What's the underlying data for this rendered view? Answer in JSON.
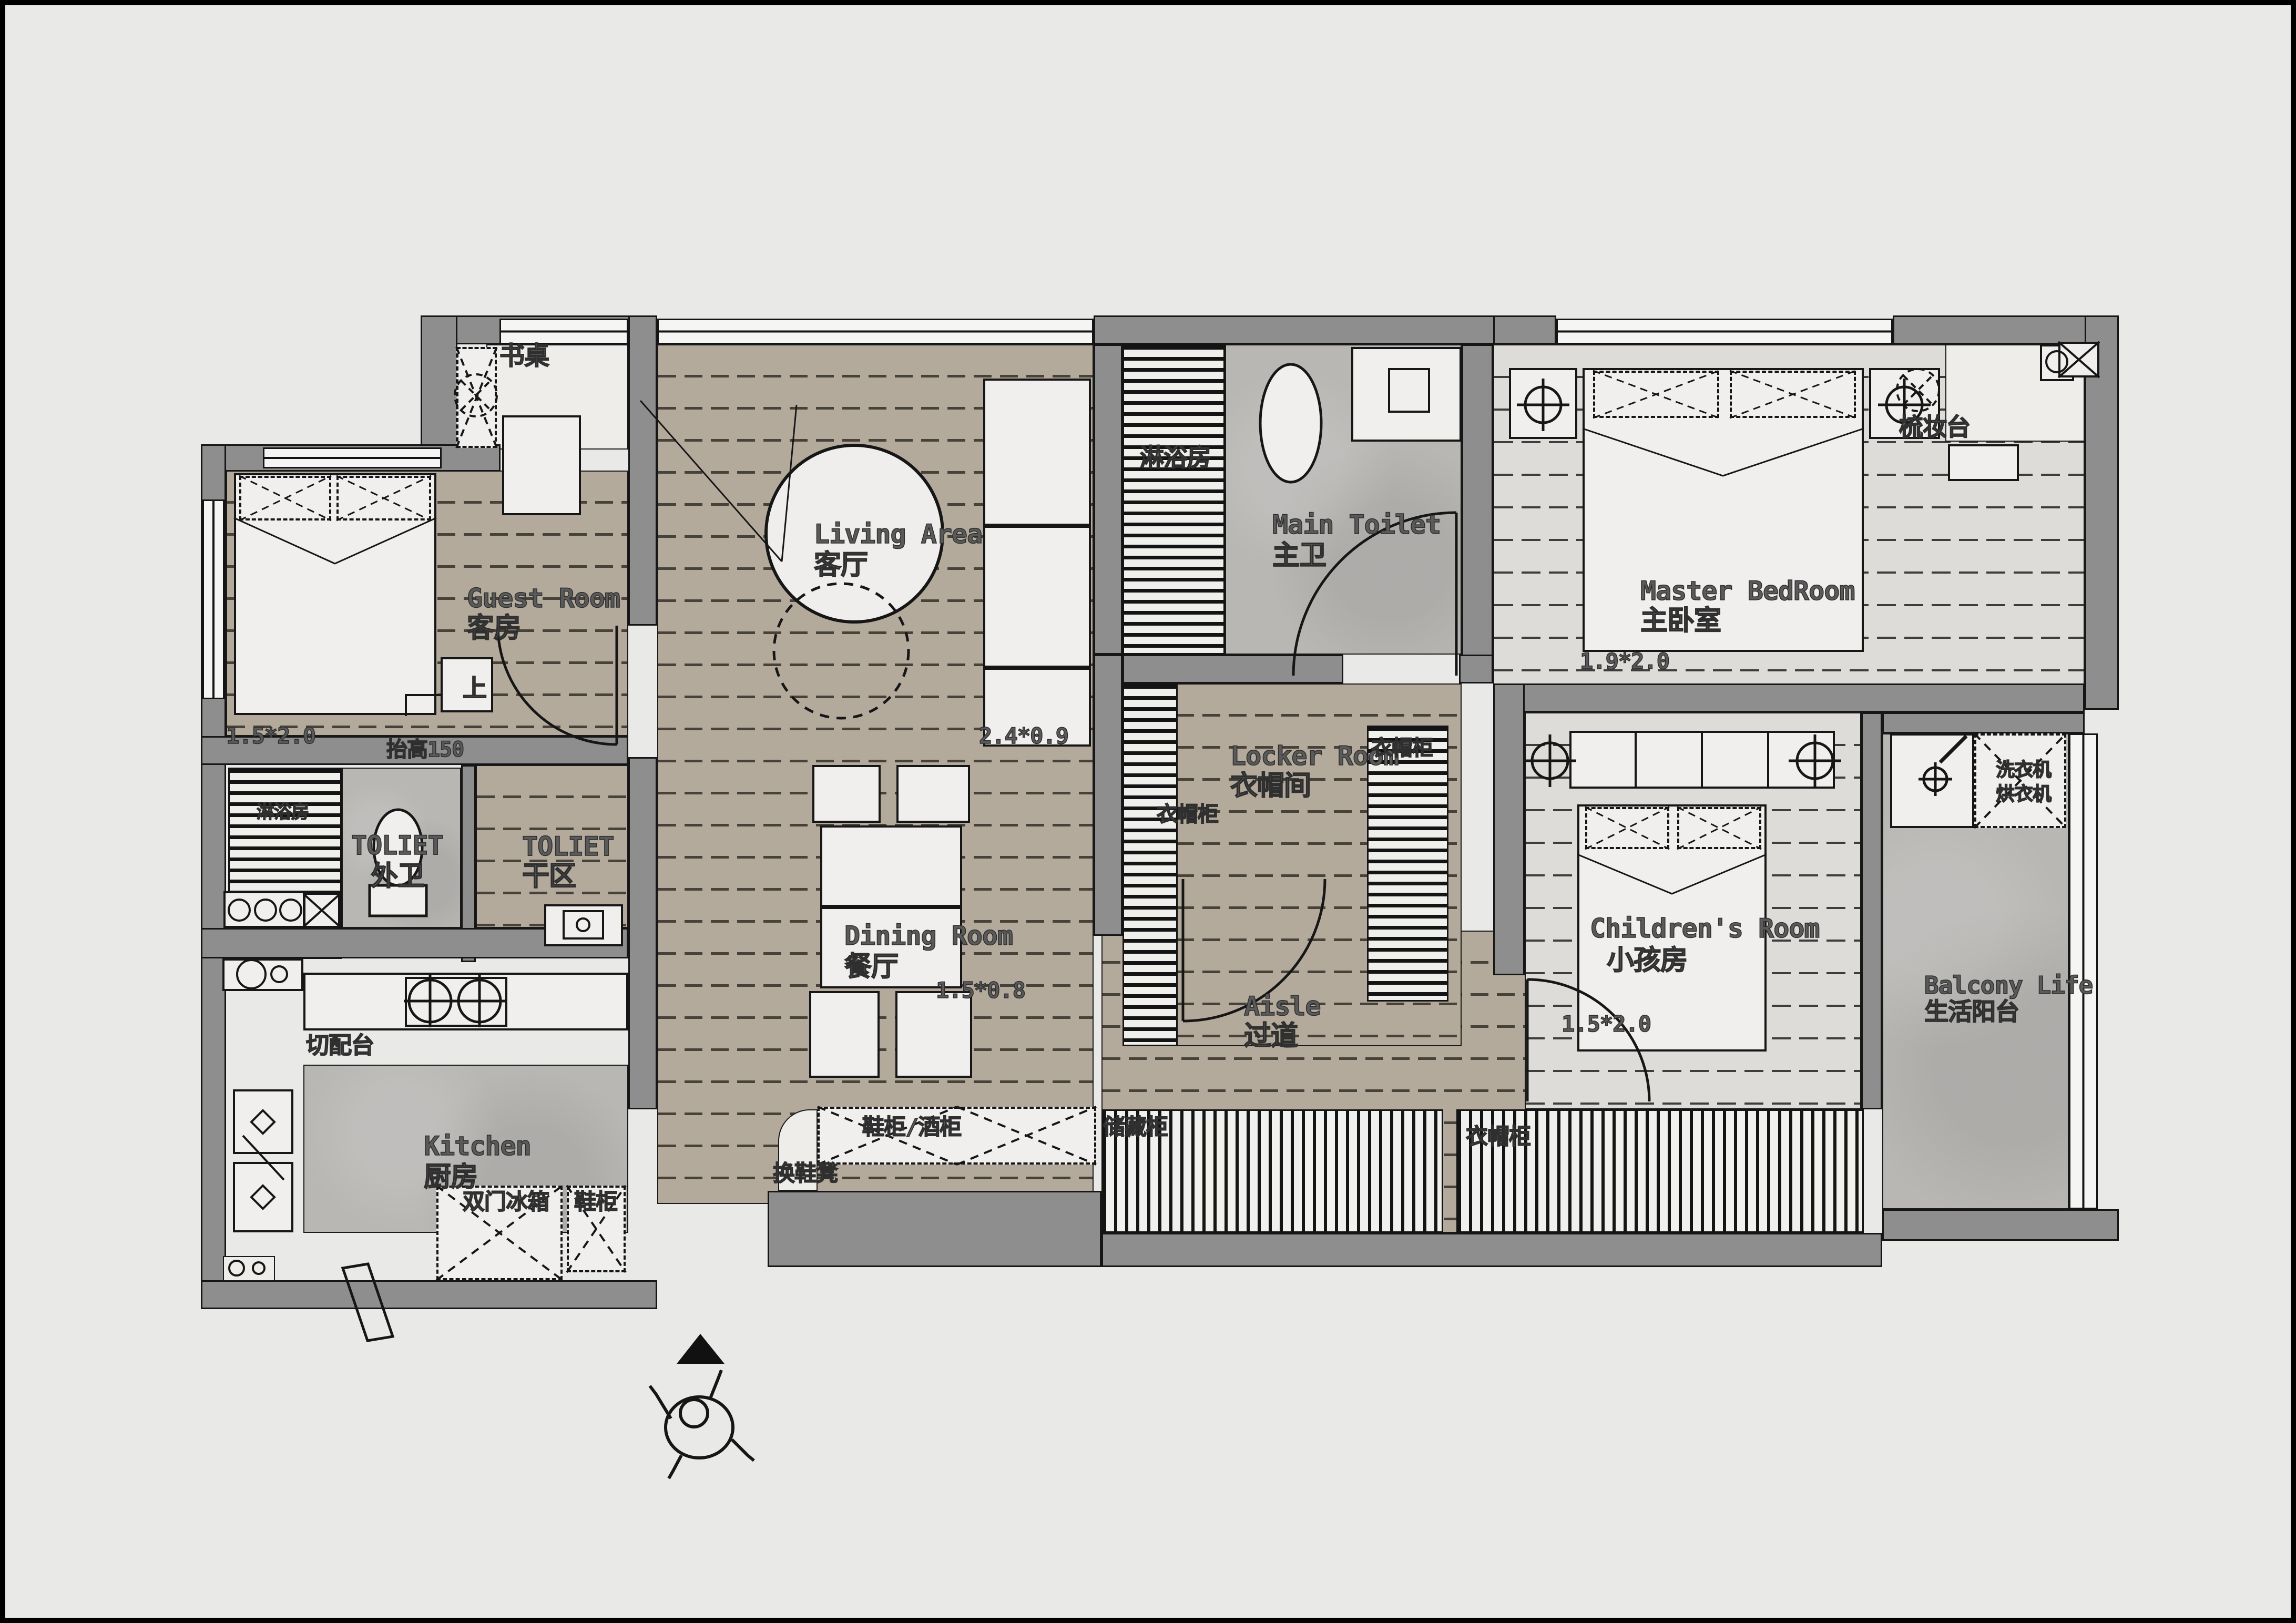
{
  "rooms": {
    "guest": {
      "en": "Guest Room",
      "zh": "客房",
      "bed_dim": "1.5*2.0"
    },
    "living": {
      "en": "Living Area",
      "zh": "客厅",
      "cabinet_dim": "2.4*0.9"
    },
    "main_toilet": {
      "en": "Main Toilet",
      "zh": "主卫"
    },
    "master_bedroom": {
      "en": "Master BedRoom",
      "zh": "主卧室",
      "bed_dim": "1.9*2.0"
    },
    "outer_toilet": {
      "en": "TOLIET",
      "zh": "外卫"
    },
    "dry_area": {
      "en": "TOLIET",
      "zh": "干区"
    },
    "dining": {
      "en": "Dining Room",
      "zh": "餐厅",
      "table_dim": "1.5*0.8"
    },
    "locker": {
      "en": "Locker Room",
      "zh": "衣帽间"
    },
    "children": {
      "en": "Children's Room",
      "zh": "小孩房",
      "bed_dim": "1.5*2.0"
    },
    "balcony": {
      "en": "Balcony Life",
      "zh": "生活阳台"
    },
    "kitchen": {
      "en": "Kitchen",
      "zh": "厨房"
    },
    "aisle": {
      "en": "Aisle",
      "zh": "过道"
    }
  },
  "fixtures": {
    "desk": "书桌",
    "dressing_table": "梳妆台",
    "shower_room_top": "淋浴房",
    "shower_room_front": "淋浴房",
    "raised_note": "抬高150",
    "step_up": "上",
    "wardrobe_cabinet_left": "衣帽柜",
    "wardrobe_cabinet_mid": "衣帽柜",
    "washer": "洗衣机",
    "dryer": "烘衣机",
    "prep_counter": "切配台",
    "double_door_fridge": "双门冰箱",
    "shoe_cabinet": "鞋柜",
    "shoe_bench": "换鞋凳",
    "shoe_wine_cabinet": "鞋柜/酒柜",
    "storage_cabinet": "储藏柜",
    "coat_cabinet": "衣帽柜"
  },
  "colors": {
    "wall": "#8e8e8e",
    "wood_floor": "#b4aa9c",
    "bedroom_floor": "#dedcd8",
    "concrete": "#b8b7b4",
    "background": "#e9e9e7",
    "line": "#161616",
    "label": "#4a4a4a"
  }
}
